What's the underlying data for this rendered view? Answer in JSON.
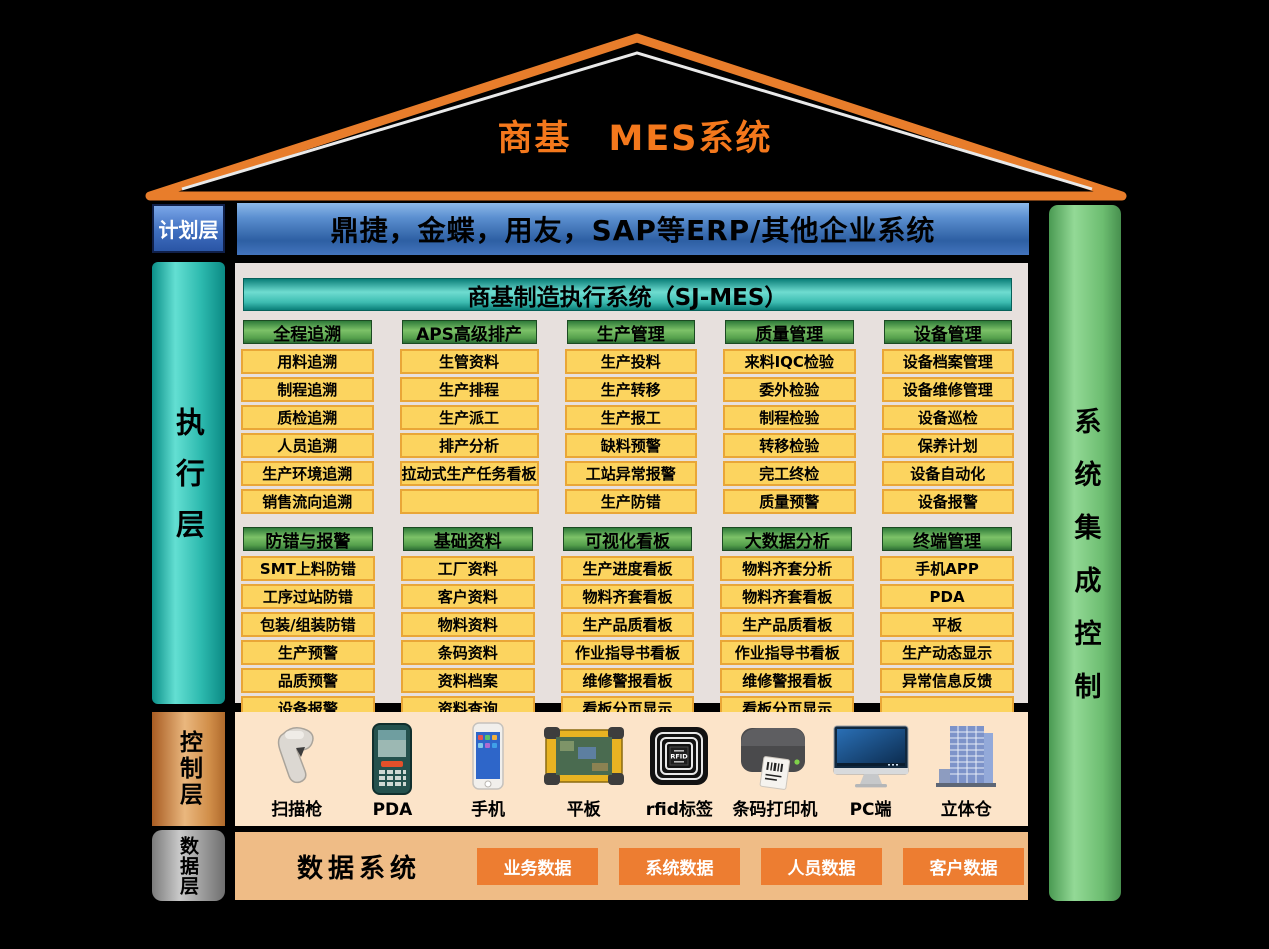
{
  "title": "商基　MES系统",
  "plan_layer": {
    "label": "计划层",
    "erp_bar": "鼎捷，金蝶，用友，SAP等ERP/其他企业系统"
  },
  "execution_layer": {
    "label": "执行层",
    "panel_title": "商基制造执行系统（SJ-MES）",
    "rows": [
      {
        "columns": [
          {
            "header": "全程追溯",
            "items": [
              "用料追溯",
              "制程追溯",
              "质检追溯",
              "人员追溯",
              "生产环境追溯",
              "销售流向追溯"
            ]
          },
          {
            "header": "APS高级排产",
            "items": [
              "生管资料",
              "生产排程",
              "生产派工",
              "排产分析",
              "拉动式生产任务看板",
              ""
            ]
          },
          {
            "header": "生产管理",
            "items": [
              "生产投料",
              "生产转移",
              "生产报工",
              "缺料预警",
              "工站异常报警",
              "生产防错"
            ]
          },
          {
            "header": "质量管理",
            "items": [
              "来料IQC检验",
              "委外检验",
              "制程检验",
              "转移检验",
              "完工终检",
              "质量预警"
            ]
          },
          {
            "header": "设备管理",
            "items": [
              "设备档案管理",
              "设备维修管理",
              "设备巡检",
              "保养计划",
              "设备自动化",
              "设备报警"
            ]
          }
        ]
      },
      {
        "columns": [
          {
            "header": "防错与报警",
            "items": [
              "SMT上料防错",
              "工序过站防错",
              "包装/组装防错",
              "生产预警",
              "品质预警",
              "设备报警"
            ]
          },
          {
            "header": "基础资料",
            "items": [
              "工厂资料",
              "客户资料",
              "物料资料",
              "条码资料",
              "资料档案",
              "资料查询"
            ]
          },
          {
            "header": "可视化看板",
            "items": [
              "生产进度看板",
              "物料齐套看板",
              "生产品质看板",
              "作业指导书看板",
              "维修警报看板",
              "看板分页显示"
            ]
          },
          {
            "header": "大数据分析",
            "items": [
              "物料齐套分析",
              "物料齐套看板",
              "生产品质看板",
              "作业指导书看板",
              "维修警报看板",
              "看板分页显示"
            ]
          },
          {
            "header": "终端管理",
            "items": [
              "手机APP",
              "PDA",
              "平板",
              "生产动态显示",
              "异常信息反馈",
              ""
            ]
          }
        ]
      }
    ]
  },
  "system_integration": {
    "label": "系统集成控制"
  },
  "control_layer": {
    "label": "控制层",
    "devices": [
      {
        "icon": "barcode-scanner",
        "label": "扫描枪"
      },
      {
        "icon": "pda",
        "label": "PDA"
      },
      {
        "icon": "smartphone",
        "label": "手机"
      },
      {
        "icon": "tablet",
        "label": "平板"
      },
      {
        "icon": "rfid-tag",
        "label": "rfid标签"
      },
      {
        "icon": "label-printer",
        "label": "条码打印机"
      },
      {
        "icon": "pc-monitor",
        "label": "PC端"
      },
      {
        "icon": "warehouse",
        "label": "立体仓"
      }
    ]
  },
  "data_layer": {
    "label": "数据层",
    "title": "数据系统",
    "boxes": [
      "业务数据",
      "系统数据",
      "人员数据",
      "客户数据"
    ]
  },
  "colors": {
    "roof_orange": "#E87D2B",
    "title_orange": "#F4781C",
    "erp_blue": "#3F6FC0",
    "exec_teal": "#2CB9AE",
    "header_green": "#55A04C",
    "item_yellow": "#FCD45F",
    "item_border": "#E9A637",
    "integration_green": "#6CBD70",
    "control_peach": "#FCE4C9",
    "data_peach": "#EFBC86",
    "data_box_orange": "#ED7D31"
  }
}
